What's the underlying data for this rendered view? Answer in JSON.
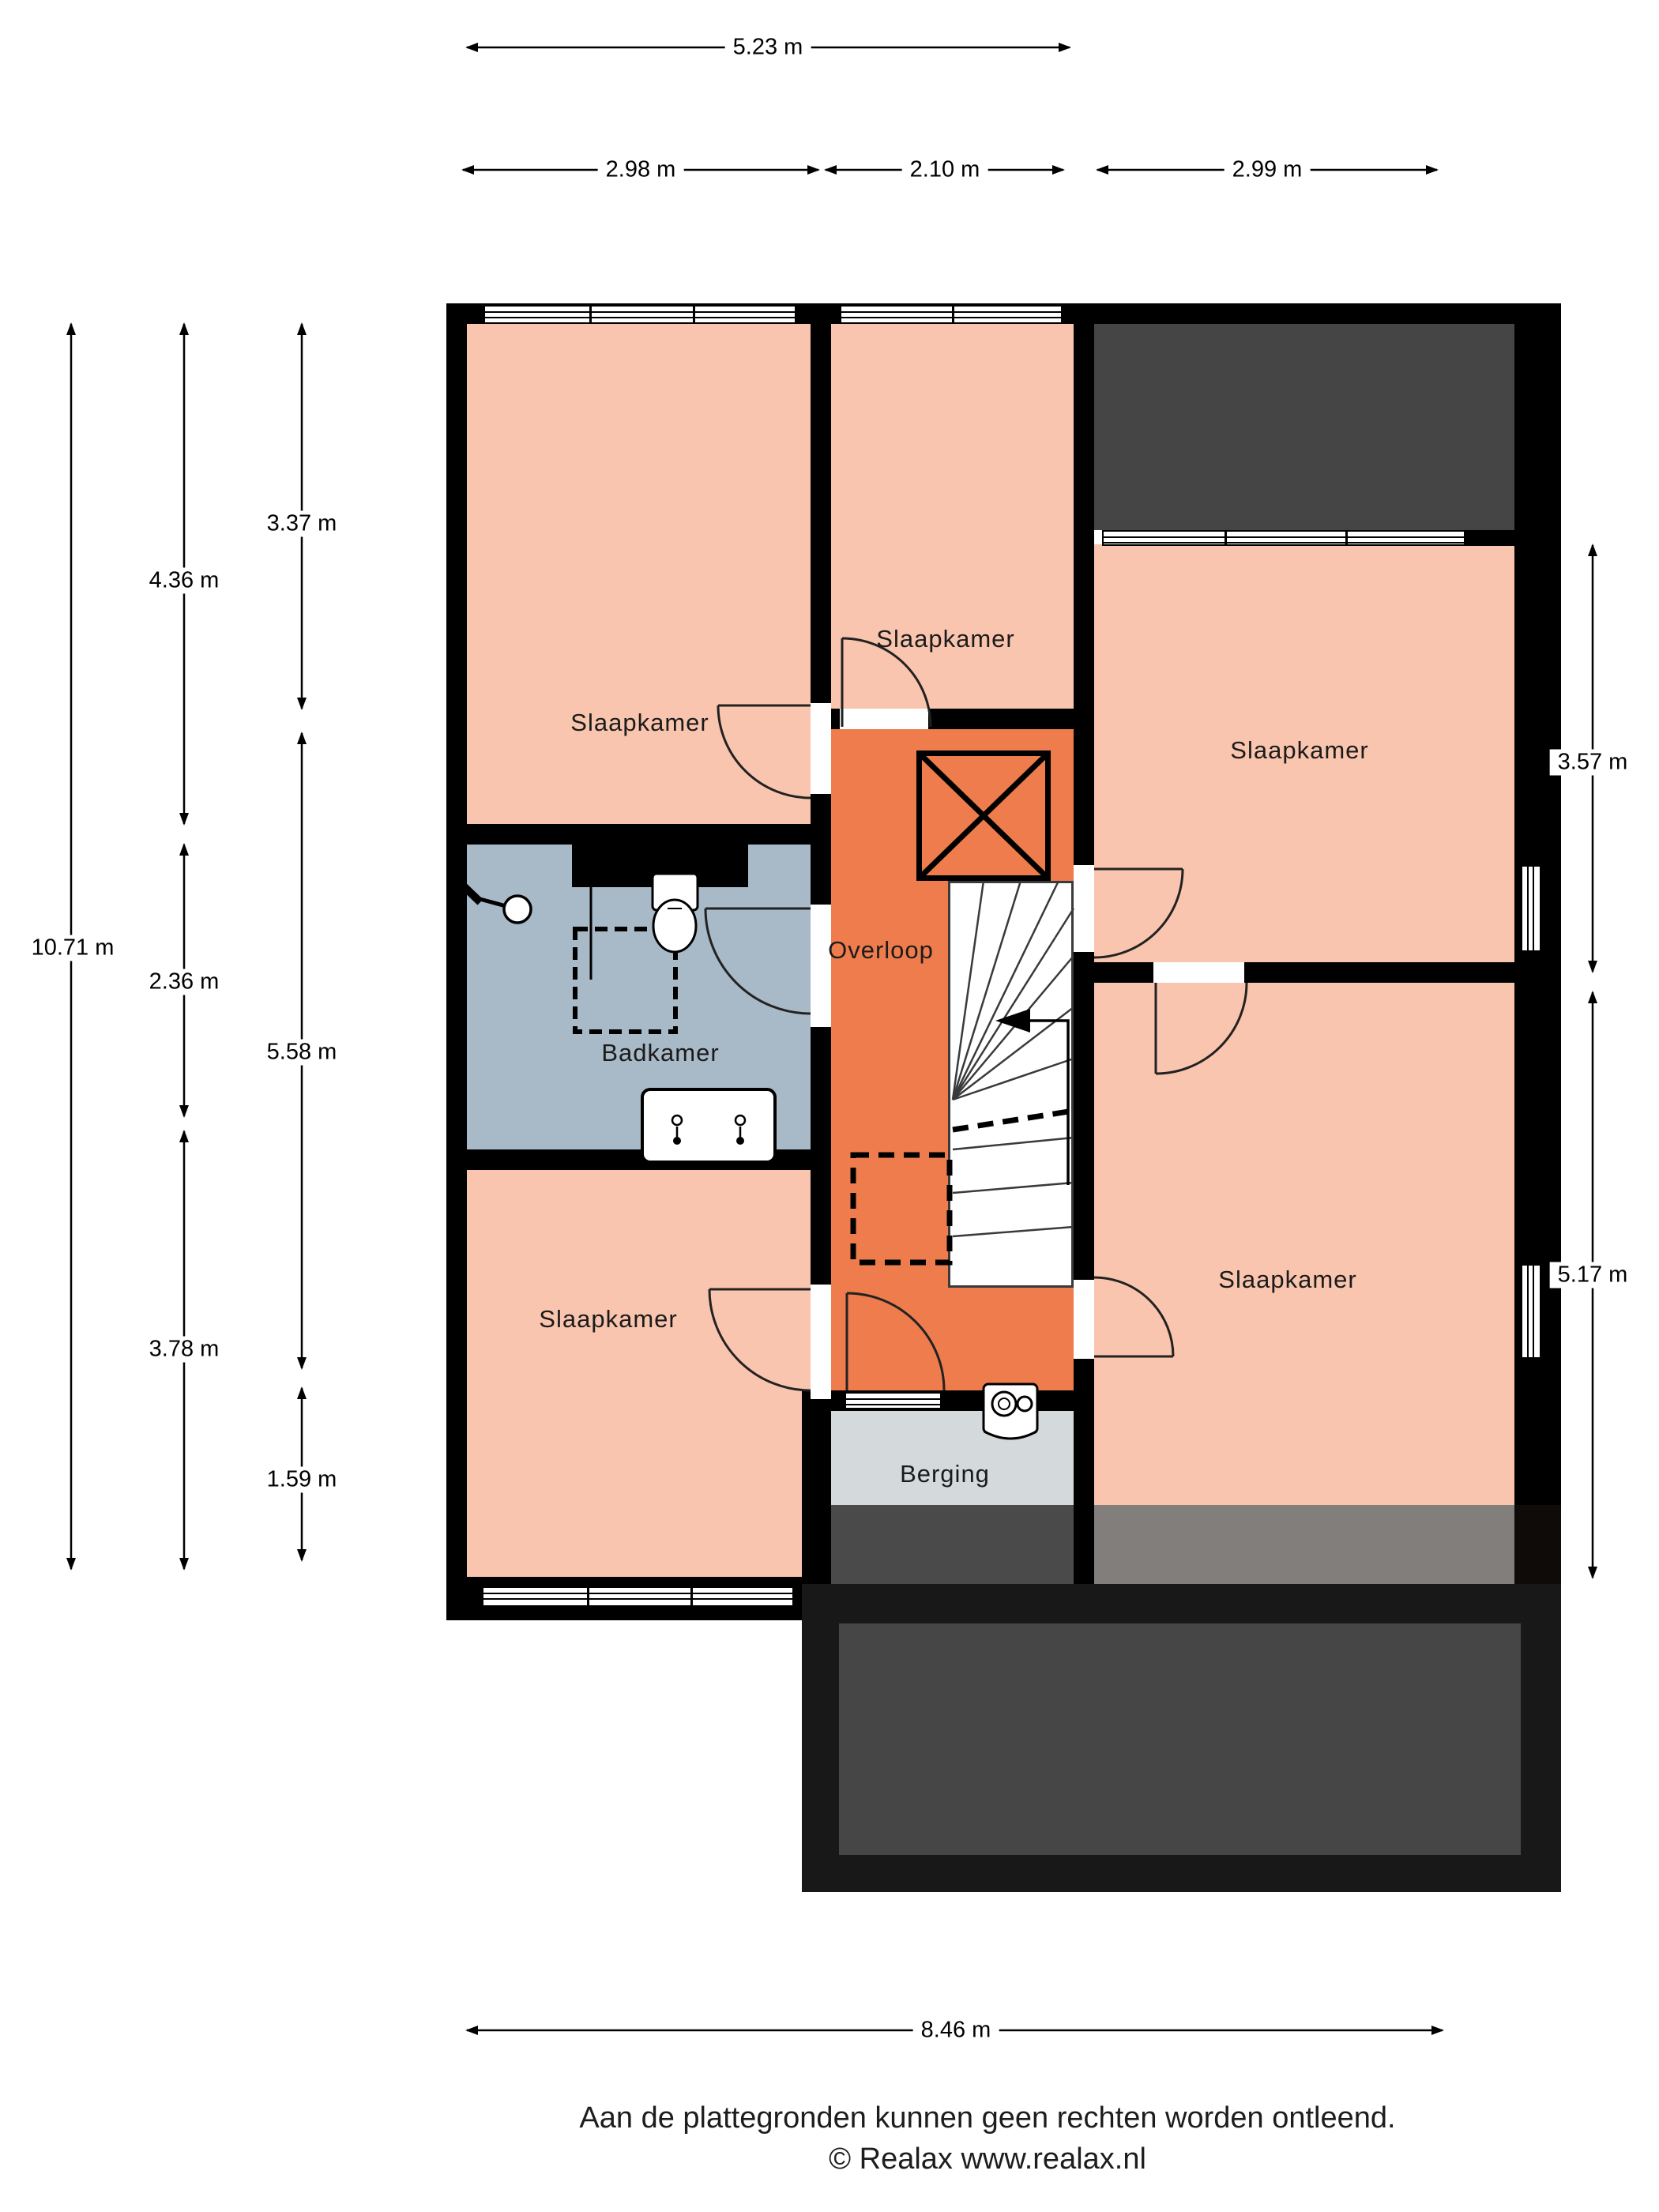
{
  "title": "Plattegrond verdieping",
  "rooms": {
    "bedroom_top_left": "Slaapkamer",
    "bedroom_top_middle": "Slaapkamer",
    "bedroom_right": "Slaapkamer",
    "bedroom_bottom_left": "Slaapkamer",
    "bedroom_bottom_right": "Slaapkamer",
    "landing": "Overloop",
    "bathroom": "Badkamer",
    "storage": "Berging"
  },
  "dimensions": {
    "top_overall": "5.23 m",
    "top": [
      "2.98 m",
      "2.10 m",
      "2.99 m"
    ],
    "left_overall": "10.71 m",
    "left_outer": [
      "4.36 m",
      "2.36 m",
      "3.78 m"
    ],
    "left_inner": [
      "3.37 m",
      "5.58 m",
      "1.59 m"
    ],
    "right": [
      "3.57 m",
      "5.17 m"
    ],
    "bottom": "8.46 m"
  },
  "footer": {
    "disclaimer": "Aan de plattegronden kunnen geen rechten worden ontleend.",
    "copyright": "© Realax www.realax.nl"
  },
  "colors": {
    "bedroom_fill": "#f9c5ae",
    "landing_fill": "#ee7c4c",
    "bathroom_fill": "#a8b9c7",
    "storage_fill": "#d4d9dc",
    "roof_fill": "#454545",
    "wall": "#000000"
  },
  "icons": {
    "stairs": "stairs-icon",
    "void": "void-cross-icon",
    "shower": "shower-icon",
    "toilet": "toilet-icon",
    "sink": "sink-icon",
    "boiler": "boiler-icon",
    "window": "window-symbol",
    "door": "door-symbol"
  }
}
